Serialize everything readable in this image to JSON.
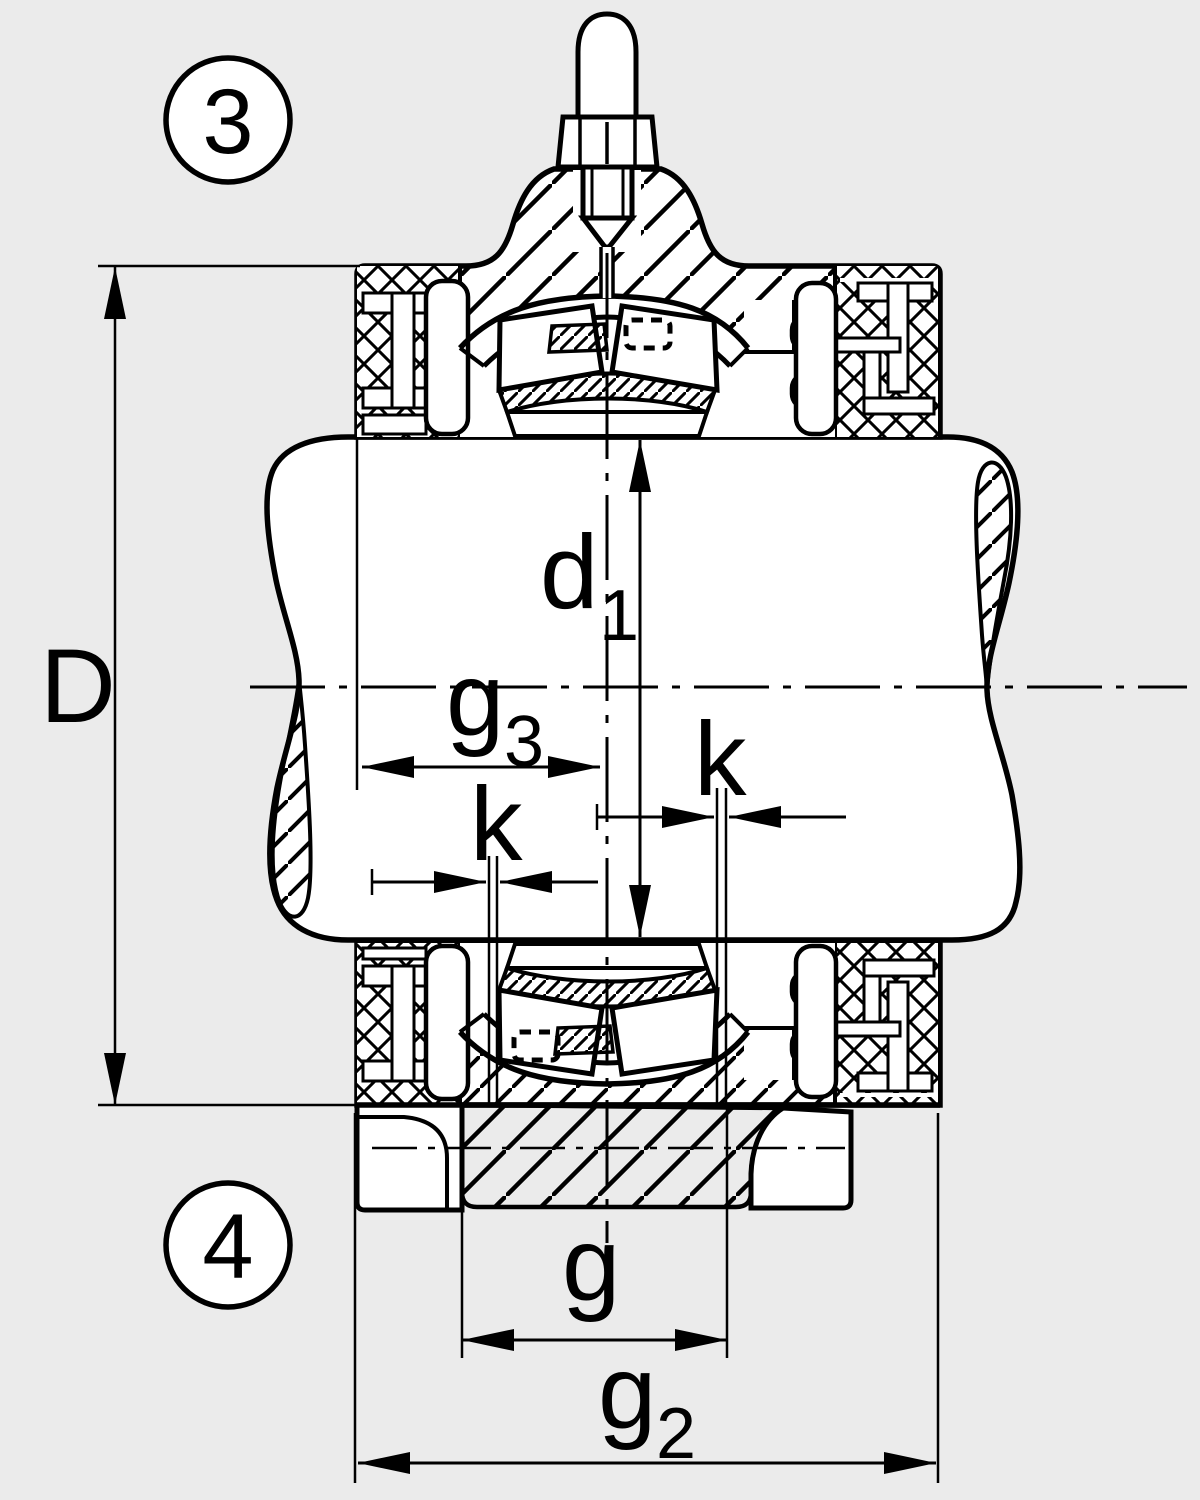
{
  "figure": {
    "kind": "technical-drawing",
    "subject": "Cross-section of a split plummer block bearing housing with spherical roller bearing, shaft and lubrication-hole dimensions",
    "colors": {
      "background": "#ebebeb",
      "ink": "#000000",
      "paper": "#ffffff"
    }
  },
  "balloons": {
    "top": {
      "number": "3"
    },
    "bottom": {
      "number": "4"
    }
  },
  "labels": {
    "D": {
      "text": "D"
    },
    "d1": {
      "base": "d",
      "sub": "1"
    },
    "g3": {
      "base": "g",
      "sub": "3"
    },
    "k_left": {
      "text": "k"
    },
    "k_right": {
      "text": "k"
    },
    "g": {
      "text": "g"
    },
    "g2": {
      "base": "g",
      "sub": "2"
    }
  }
}
